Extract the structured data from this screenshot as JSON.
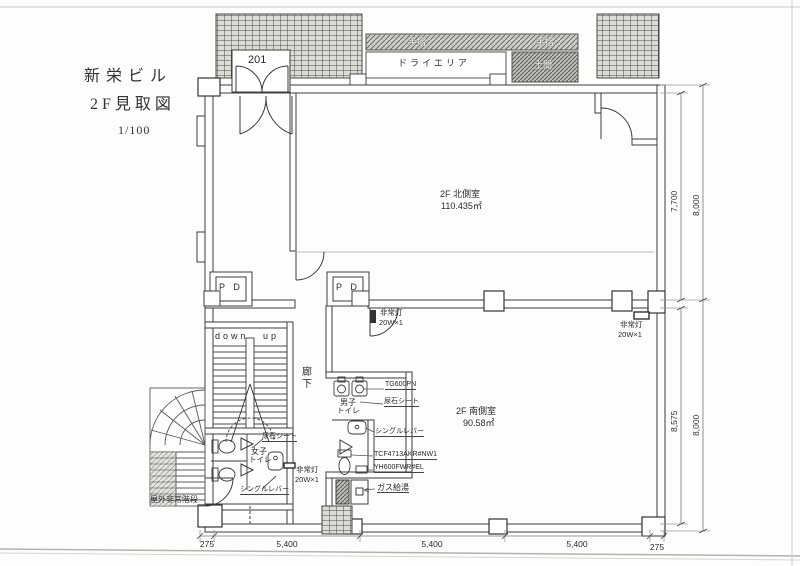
{
  "labels": {
    "title1": "新栄ビル",
    "title2": "2F見取図",
    "scale": "1/100",
    "room201": "201",
    "dry_area": "ドライエリア",
    "railing": "手摺",
    "doma": "土間",
    "north_room_name": "2F 北側室",
    "north_room_area": "110.435㎡",
    "south_room_name": "2F 南側室",
    "south_room_area": "90.58㎡",
    "pd": "P D",
    "down": "down",
    "up": "up",
    "corridor": "廊下",
    "mens_1": "男子",
    "mens_2": "トイレ",
    "womens_1": "女子",
    "womens_2": "トイレ",
    "emergency_light": "非常灯",
    "emergency_light_spec": "20W×1",
    "urinal_model": "TG600PN",
    "urinal_sheet": "尿石シート",
    "single_lever": "シングルレバー",
    "washlet_model": "TCF4713AKR#NW1",
    "paper_holder": "YH600FWR#EL",
    "gas_heater": "ガス給湯",
    "outdoor_stairs": "屋外非常階段"
  },
  "dimensions": {
    "right_top_inner": "7,700",
    "right_top_outer": "8,000",
    "right_bottom_inner": "8,575",
    "right_bottom_outer": "8,000",
    "bottom": [
      "275",
      "5,400",
      "5,400",
      "5,400",
      "275"
    ]
  }
}
